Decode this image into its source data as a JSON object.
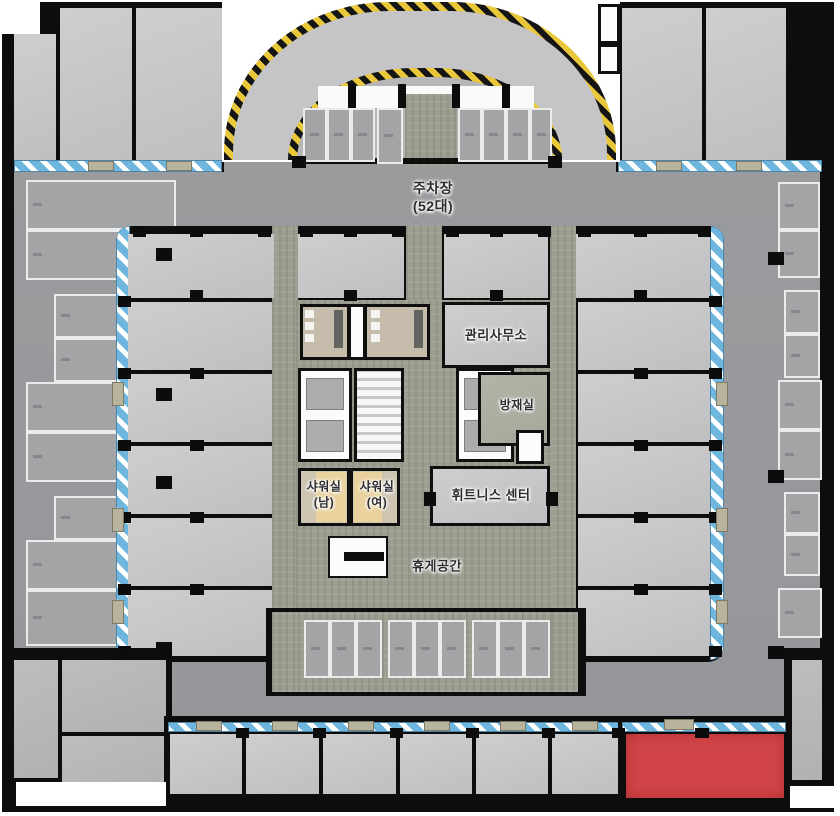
{
  "labels": {
    "parking": "주차장\n(52대)",
    "management_office": "관리사무소",
    "disaster_prevention": "방재실",
    "shower_men": "샤워실\n(남)",
    "shower_women": "샤워실\n(여)",
    "fitness_center": "휘트니스 센터",
    "rest_area": "휴게공간"
  },
  "colors": {
    "highlight": "#d14549",
    "glass": "#6fb6df",
    "hazard": "#e9c73a",
    "corridor": "#9b9e90",
    "driveway": "#98999b",
    "unit": "#c8c8ca",
    "shower": "#e9d29e",
    "restroom": "#c5bcab"
  },
  "geometry": {
    "topband_left_units": [
      [
        14,
        34,
        42,
        126
      ],
      [
        60,
        8,
        72,
        152
      ],
      [
        136,
        8,
        86,
        152
      ]
    ],
    "topband_right_units": [
      [
        622,
        8,
        80,
        152
      ],
      [
        706,
        8,
        80,
        152
      ]
    ],
    "ramp_stalls": [
      [
        303,
        108,
        24,
        54
      ],
      [
        327,
        108,
        24,
        54
      ],
      [
        351,
        108,
        24,
        54
      ],
      [
        377,
        108,
        26,
        56
      ],
      [
        458,
        108,
        24,
        54
      ],
      [
        482,
        108,
        24,
        54
      ],
      [
        506,
        108,
        24,
        54
      ],
      [
        530,
        108,
        22,
        54
      ]
    ],
    "left_stalls": [
      [
        26,
        180,
        150,
        50
      ],
      [
        26,
        230,
        150,
        50
      ],
      [
        54,
        294,
        124,
        44
      ],
      [
        54,
        338,
        124,
        44
      ],
      [
        26,
        382,
        152,
        50
      ],
      [
        26,
        432,
        152,
        50
      ],
      [
        54,
        496,
        124,
        44
      ],
      [
        26,
        540,
        152,
        50
      ],
      [
        26,
        590,
        152,
        56
      ]
    ],
    "right_stalls": [
      [
        778,
        182,
        42,
        48
      ],
      [
        778,
        230,
        42,
        48
      ],
      [
        784,
        290,
        36,
        44
      ],
      [
        784,
        334,
        36,
        44
      ],
      [
        778,
        380,
        44,
        50
      ],
      [
        778,
        430,
        44,
        50
      ],
      [
        784,
        492,
        36,
        42
      ],
      [
        784,
        534,
        36,
        42
      ],
      [
        778,
        588,
        44,
        50
      ]
    ],
    "top_units": [
      [
        128,
        234,
        146,
        64
      ],
      [
        298,
        234,
        106,
        64
      ],
      [
        444,
        234,
        104,
        64
      ],
      [
        576,
        234,
        134,
        64
      ]
    ],
    "left_units": [
      [
        128,
        302,
        144,
        68
      ],
      [
        128,
        374,
        144,
        68
      ],
      [
        128,
        446,
        144,
        68
      ],
      [
        128,
        518,
        144,
        68
      ],
      [
        128,
        590,
        144,
        66
      ]
    ],
    "right_units": [
      [
        578,
        302,
        132,
        68
      ],
      [
        578,
        374,
        132,
        68
      ],
      [
        578,
        446,
        132,
        68
      ],
      [
        578,
        518,
        132,
        68
      ],
      [
        578,
        590,
        132,
        66
      ]
    ],
    "bay_stalls": [
      [
        304,
        620,
        26,
        58
      ],
      [
        330,
        620,
        26,
        58
      ],
      [
        356,
        620,
        26,
        58
      ],
      [
        388,
        620,
        26,
        58
      ],
      [
        414,
        620,
        26,
        58
      ],
      [
        440,
        620,
        26,
        58
      ],
      [
        472,
        620,
        26,
        58
      ],
      [
        498,
        620,
        26,
        58
      ],
      [
        524,
        620,
        26,
        58
      ]
    ],
    "bottom_units": [
      [
        170,
        734,
        72,
        60
      ],
      [
        246,
        734,
        73,
        60
      ],
      [
        323,
        734,
        73,
        60
      ],
      [
        400,
        734,
        72,
        60
      ],
      [
        476,
        734,
        72,
        60
      ],
      [
        552,
        734,
        66,
        60
      ]
    ],
    "corner_rooms_sw": [
      [
        14,
        660,
        44,
        118
      ],
      [
        62,
        660,
        104,
        72
      ],
      [
        62,
        736,
        104,
        60
      ]
    ],
    "corner_rooms_se": [
      [
        792,
        660,
        30,
        120
      ]
    ],
    "white_boxes": [
      [
        598,
        4,
        22,
        40
      ],
      [
        598,
        44,
        22,
        30
      ]
    ],
    "elevator_cars": [
      [
        306,
        378,
        38,
        32
      ],
      [
        306,
        420,
        38,
        32
      ],
      [
        464,
        378,
        42,
        32
      ],
      [
        464,
        420,
        42,
        32
      ]
    ],
    "restroom_fixtures_white": [
      [
        305,
        310,
        9,
        8
      ],
      [
        305,
        322,
        9,
        8
      ],
      [
        305,
        334,
        9,
        8
      ],
      [
        371,
        310,
        9,
        8
      ],
      [
        371,
        322,
        9,
        8
      ],
      [
        371,
        334,
        9,
        8
      ]
    ],
    "restroom_fixtures_dark": [
      [
        334,
        310,
        9,
        38
      ],
      [
        414,
        310,
        9,
        38
      ]
    ],
    "shower_floors": [
      [
        316,
        472,
        30,
        50
      ],
      [
        354,
        472,
        28,
        50
      ]
    ],
    "columns": [
      [
        133,
        226,
        13,
        11
      ],
      [
        190,
        226,
        13,
        11
      ],
      [
        258,
        226,
        13,
        11
      ],
      [
        300,
        226,
        13,
        11
      ],
      [
        344,
        226,
        13,
        11
      ],
      [
        392,
        226,
        13,
        11
      ],
      [
        446,
        226,
        13,
        11
      ],
      [
        490,
        226,
        13,
        11
      ],
      [
        538,
        226,
        13,
        11
      ],
      [
        578,
        226,
        13,
        11
      ],
      [
        634,
        226,
        13,
        11
      ],
      [
        698,
        226,
        13,
        11
      ],
      [
        190,
        290,
        13,
        11
      ],
      [
        344,
        290,
        13,
        11
      ],
      [
        490,
        290,
        13,
        11
      ],
      [
        634,
        290,
        13,
        11
      ],
      [
        118,
        296,
        13,
        11
      ],
      [
        118,
        368,
        13,
        11
      ],
      [
        118,
        440,
        13,
        11
      ],
      [
        118,
        512,
        13,
        11
      ],
      [
        118,
        584,
        13,
        11
      ],
      [
        118,
        646,
        13,
        11
      ],
      [
        709,
        296,
        13,
        11
      ],
      [
        709,
        368,
        13,
        11
      ],
      [
        709,
        440,
        13,
        11
      ],
      [
        709,
        512,
        13,
        11
      ],
      [
        709,
        584,
        13,
        11
      ],
      [
        709,
        646,
        13,
        11
      ],
      [
        190,
        368,
        14,
        11
      ],
      [
        190,
        440,
        14,
        11
      ],
      [
        190,
        512,
        14,
        11
      ],
      [
        190,
        584,
        14,
        11
      ],
      [
        634,
        368,
        14,
        11
      ],
      [
        634,
        440,
        14,
        11
      ],
      [
        634,
        512,
        14,
        11
      ],
      [
        634,
        584,
        14,
        11
      ],
      [
        236,
        728,
        13,
        10
      ],
      [
        313,
        728,
        13,
        10
      ],
      [
        390,
        728,
        13,
        10
      ],
      [
        466,
        728,
        13,
        10
      ],
      [
        542,
        728,
        13,
        10
      ],
      [
        612,
        728,
        13,
        10
      ],
      [
        695,
        728,
        14,
        10
      ],
      [
        156,
        248,
        16,
        13
      ],
      [
        156,
        388,
        16,
        13
      ],
      [
        156,
        476,
        16,
        13
      ],
      [
        156,
        642,
        16,
        13
      ],
      [
        768,
        252,
        16,
        13
      ],
      [
        768,
        470,
        16,
        13
      ],
      [
        768,
        646,
        16,
        13
      ],
      [
        348,
        84,
        8,
        24
      ],
      [
        398,
        84,
        8,
        24
      ],
      [
        452,
        84,
        8,
        24
      ],
      [
        502,
        84,
        8,
        24
      ],
      [
        292,
        156,
        14,
        12
      ],
      [
        548,
        156,
        14,
        12
      ],
      [
        424,
        492,
        12,
        14
      ],
      [
        546,
        492,
        12,
        14
      ]
    ],
    "door_tabs": [
      [
        88,
        161,
        26,
        10
      ],
      [
        166,
        161,
        26,
        10
      ],
      [
        656,
        161,
        26,
        10
      ],
      [
        736,
        161,
        26,
        10
      ],
      [
        112,
        382,
        12,
        24
      ],
      [
        112,
        508,
        12,
        24
      ],
      [
        112,
        600,
        12,
        24
      ],
      [
        716,
        382,
        12,
        24
      ],
      [
        716,
        508,
        12,
        24
      ],
      [
        716,
        600,
        12,
        24
      ],
      [
        196,
        721,
        26,
        10
      ],
      [
        272,
        721,
        26,
        10
      ],
      [
        348,
        721,
        26,
        10
      ],
      [
        424,
        721,
        26,
        10
      ],
      [
        500,
        721,
        26,
        10
      ],
      [
        572,
        721,
        26,
        10
      ],
      [
        664,
        719,
        30,
        11
      ]
    ]
  }
}
